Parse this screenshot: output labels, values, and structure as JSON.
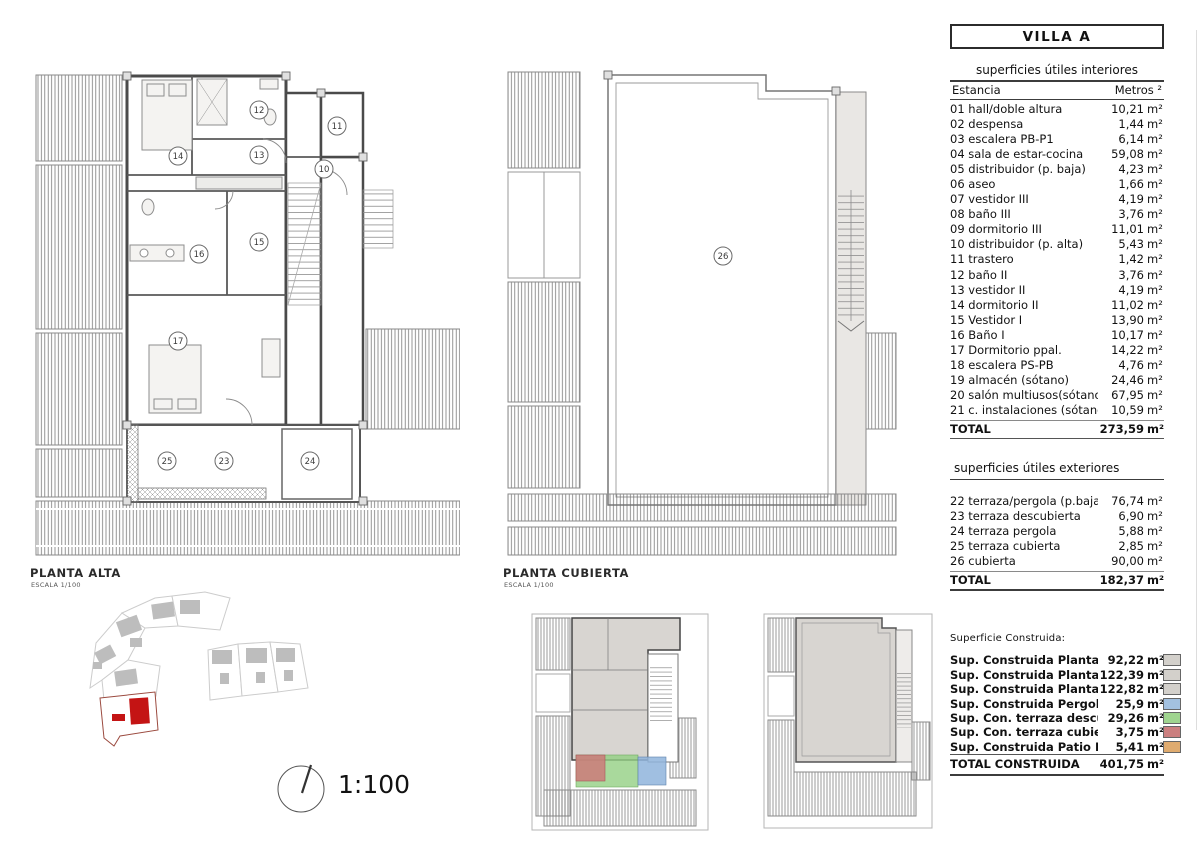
{
  "title_box": {
    "title": "VILLA A"
  },
  "units": {
    "m2": "m²"
  },
  "plans": {
    "alta": {
      "name": "PLANTA ALTA",
      "scale_label": "ESCALA 1/100",
      "room_numbers": [
        "14",
        "12",
        "11",
        "13",
        "10",
        "15",
        "16",
        "17",
        "25",
        "23",
        "24"
      ]
    },
    "cubierta": {
      "name": "PLANTA CUBIERTA",
      "scale_label": "ESCALA 1/100",
      "room_numbers": [
        "26"
      ]
    }
  },
  "scale_indicator": {
    "label": "1:100"
  },
  "site": {
    "highlight_color": "#c41414"
  },
  "overlays": {
    "red": "#cc7a7a",
    "green": "#93cf83",
    "blue": "#8fb4dc"
  },
  "tables": {
    "interior": {
      "title": "superficies útiles interiores",
      "col_room": "Estancia",
      "col_area": "Metros ²",
      "rows": [
        {
          "label": "01 hall/doble altura",
          "value": "10,21"
        },
        {
          "label": "02 despensa",
          "value": "1,44"
        },
        {
          "label": "03 escalera PB-P1",
          "value": "6,14"
        },
        {
          "label": "04 sala de estar-cocina",
          "value": "59,08"
        },
        {
          "label": "05 distribuidor (p. baja)",
          "value": "4,23"
        },
        {
          "label": "06 aseo",
          "value": "1,66"
        },
        {
          "label": "07 vestidor III",
          "value": "4,19"
        },
        {
          "label": "08 baño III",
          "value": "3,76"
        },
        {
          "label": "09 dormitorio III",
          "value": "11,01"
        },
        {
          "label": "10 distribuidor (p. alta)",
          "value": "5,43"
        },
        {
          "label": "11 trastero",
          "value": "1,42"
        },
        {
          "label": "12 baño II",
          "value": "3,76"
        },
        {
          "label": "13 vestidor II",
          "value": "4,19"
        },
        {
          "label": "14 dormitorio II",
          "value": "11,02"
        },
        {
          "label": "15 Vestidor I",
          "value": "13,90"
        },
        {
          "label": "16 Baño I",
          "value": "10,17"
        },
        {
          "label": "17 Dormitorio ppal.",
          "value": "14,22"
        },
        {
          "label": "18 escalera PS-PB",
          "value": "4,76"
        },
        {
          "label": "19 almacén (sótano)",
          "value": "24,46"
        },
        {
          "label": "20 salón multiusos(sótano)",
          "value": "67,95"
        },
        {
          "label": "21 c. instalaciones (sótano)",
          "value": "10,59"
        }
      ],
      "total_label": "TOTAL",
      "total_value": "273,59"
    },
    "exterior": {
      "title": "superficies útiles exteriores",
      "rows": [
        {
          "label": "22 terraza/pergola (p.baja)",
          "value": "76,74"
        },
        {
          "label": "23 terraza descubierta",
          "value": "6,90"
        },
        {
          "label": "24 terraza pergola",
          "value": "5,88"
        },
        {
          "label": "25 terraza cubierta",
          "value": "2,85"
        },
        {
          "label": "26 cubierta",
          "value": "90,00"
        }
      ],
      "total_label": "TOTAL",
      "total_value": "182,37"
    },
    "construida": {
      "title": "Superficie Construida:",
      "rows": [
        {
          "label": "Sup. Construida Planta Alta",
          "value": "92,22",
          "color": "#d3d0cb"
        },
        {
          "label": "Sup. Construida Planta Baja",
          "value": "122,39",
          "color": "#d3d0cb"
        },
        {
          "label": "Sup. Construida Planta Sótano",
          "value": "122,82",
          "color": "#d3d0cb"
        },
        {
          "label": "Sup. Construida Pergolas",
          "value": "25,9",
          "color": "#a3c1e0"
        },
        {
          "label": "Sup. Con. terraza descubierta",
          "value": "29,26",
          "color": "#9fd48f"
        },
        {
          "label": "Sup. Con. terraza cubierta",
          "value": "3,75",
          "color": "#cb7f7f"
        },
        {
          "label": "Sup. Construida Patio Inglés",
          "value": "5,41",
          "color": "#dfab6f"
        }
      ],
      "total_label": "TOTAL CONSTRUIDA",
      "total_value": "401,75"
    }
  }
}
